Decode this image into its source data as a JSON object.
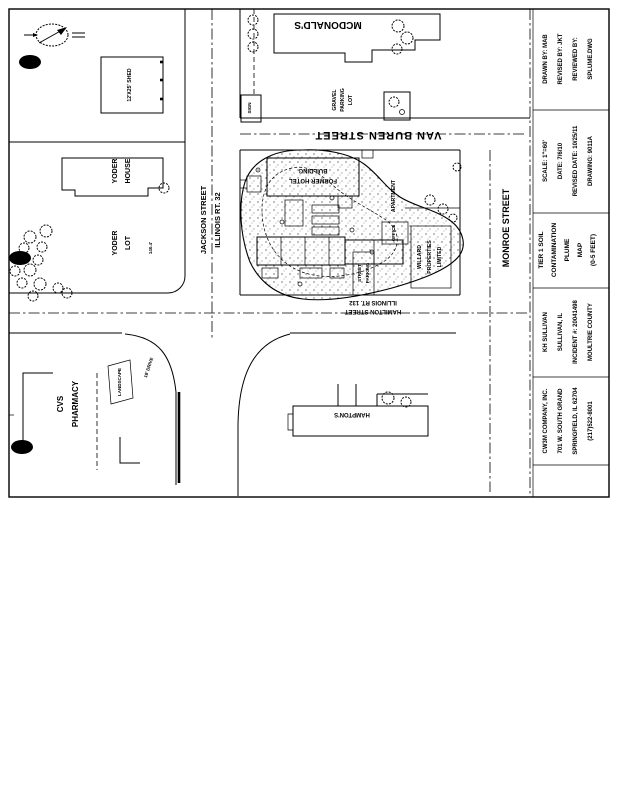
{
  "page": {
    "paper_color": "#ffffff",
    "ink_color": "#000000"
  },
  "title_block": {
    "drawn_cell": {
      "line1": "DRAWN BY: MAB",
      "line2": "REVISED BY: JKT",
      "line3": "REVIEWED BY:",
      "line4": "SPLUME.DWG"
    },
    "scale_cell": {
      "line1": "SCALE: 1\"=60'",
      "line2": "DATE: 7/6/10",
      "line3": "REVISED DATE: 10/25/11",
      "line4": "DRAWING: 9011A"
    },
    "map_title_cell": {
      "line1": "TIER 1 SOIL",
      "line2": "CONTAMINATION",
      "line3": "PLUME",
      "line4": "MAP",
      "line5": "(0-5 FEET)"
    },
    "site_cell": {
      "line1": "KH SULLIVAN",
      "line2": "SULLIVAN, IL",
      "line3": "INCIDENT #: 20041498",
      "line4": "MOULTRIE COUNTY"
    },
    "company_cell": {
      "line1": "CW3M COMPANY, INC.",
      "line2": "701 W. SOUTH GRAND",
      "line3": "SPRINGFIELD, IL 62704",
      "line4": "(217)522-8001"
    }
  },
  "streets": {
    "jackson_line1": "JACKSON STREET",
    "jackson_line2": "ILLINOIS RT. 32",
    "van_buren": "VAN BUREN STREET",
    "hamilton_line1": "HAMILTON STREET",
    "hamilton_line2": "ILLINOIS RT. 132",
    "monroe": "MONROE STREET"
  },
  "site_labels": {
    "mcdonalds": "MCDONALD'S",
    "gravel_line1": "GRAVEL",
    "gravel_line2": "PARKING",
    "gravel_line3": "LOT",
    "sign": "SIGN",
    "shed": "12'X25' SHED",
    "yoder_house_line1": "YODER",
    "yoder_house_line2": "HOUSE",
    "yoder_lot_line1": "YODER",
    "yoder_lot_line2": "LOT",
    "yoder_lot_dim": "140.4'",
    "cvs_line1": "CVS",
    "cvs_line2": "PHARMACY",
    "landscape": "LANDSCAPE",
    "drive_width": "18' DRIVE",
    "hamptons": "HAMPTON'S",
    "hotel_line1": "FORMER HOTEL",
    "hotel_line2": "BUILDING",
    "apartment": "APARTMENT",
    "office": "OFFICE",
    "parking_line1": "STREET",
    "parking_line2": "PARKING",
    "willard_line1": "WILLARD",
    "willard_line2": "PROPERTIES",
    "willard_line3": "LIMITED"
  }
}
